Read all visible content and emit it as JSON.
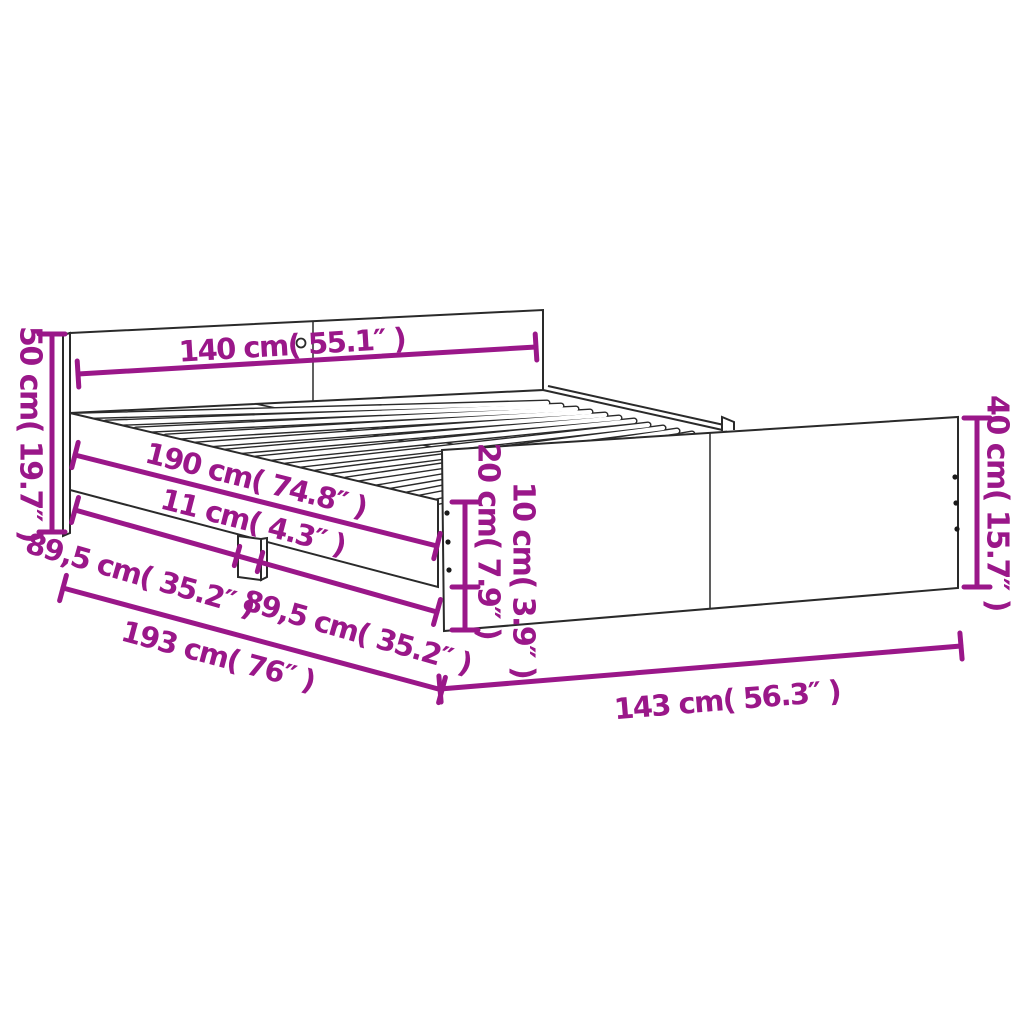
{
  "diagram": {
    "subject": "bed-frame-dimension-diagram",
    "colors": {
      "dimension_accent": "#9a1789",
      "line_art": "#2a2a2a",
      "background": "#ffffff"
    }
  },
  "dims": {
    "headboard_width": {
      "label": "140 cm( 55.1″ )"
    },
    "headboard_height": {
      "label": "50 cm( 19.7″ )"
    },
    "slat_area_length": {
      "label": "190 cm( 74.8″ )"
    },
    "leg_width": {
      "label": "11 cm( 4.3″ )"
    },
    "rail_segment_head": {
      "label": "89,5 cm( 35.2″ )"
    },
    "rail_segment_foot": {
      "label": "89,5 cm( 35.2″ )"
    },
    "total_length": {
      "label": "193 cm( 76″ )"
    },
    "rail_height": {
      "label": "20 cm( 7.9″ )"
    },
    "clearance_height": {
      "label": "10 cm( 3.9″ )"
    },
    "footboard_height": {
      "label": "40 cm( 15.7″ )"
    },
    "total_width": {
      "label": "143 cm( 56.3″ )"
    }
  }
}
